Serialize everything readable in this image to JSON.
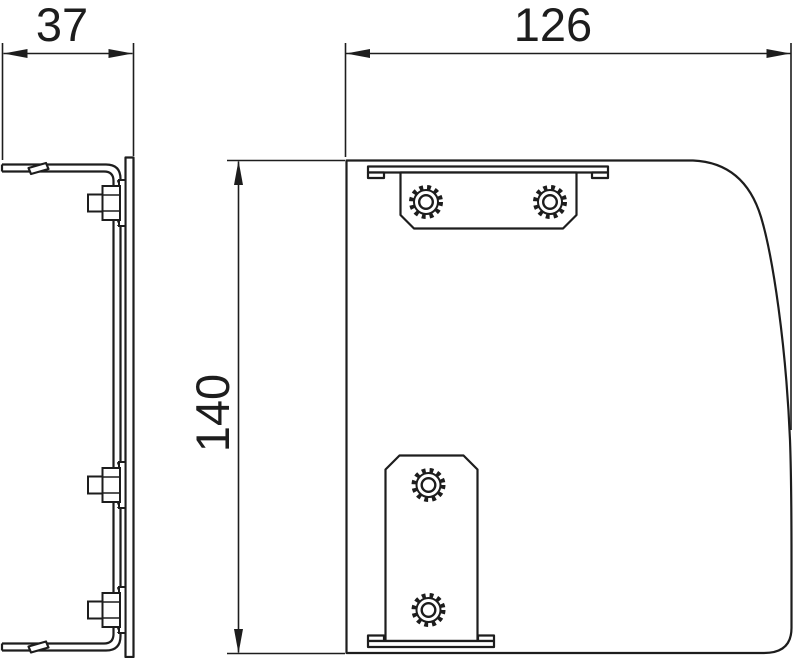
{
  "drawing": {
    "background_color": "#ffffff",
    "line_color": "#1d1d1d",
    "dimensions": {
      "side_width": {
        "value": "37",
        "orientation": "horizontal"
      },
      "front_width": {
        "value": "126",
        "orientation": "horizontal"
      },
      "front_height": {
        "value": "140",
        "orientation": "vertical"
      }
    },
    "icons": {
      "knurled_nut": "gear-ring-circle",
      "hex_bolt": "hexagon-profile",
      "dim_arrow": "filled-triangle"
    }
  }
}
